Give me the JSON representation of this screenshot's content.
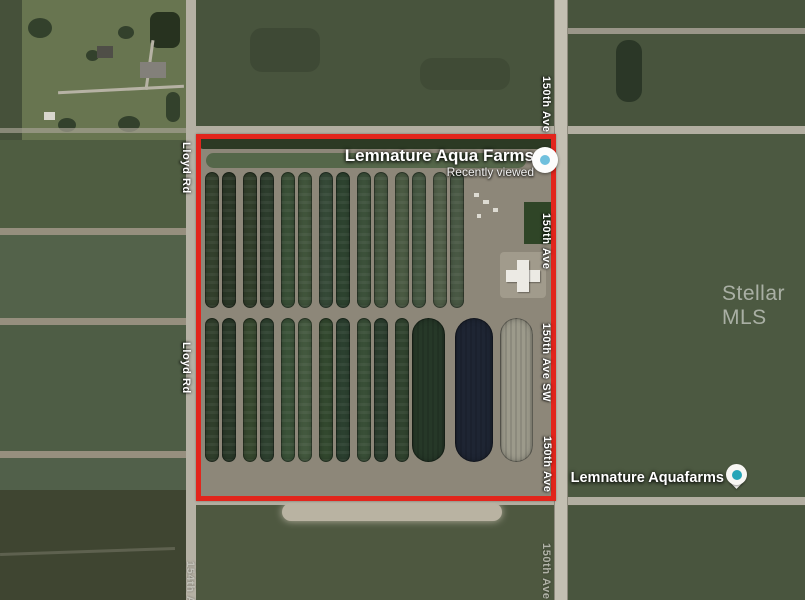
{
  "map": {
    "watermark": "Stellar MLS",
    "primary_place": {
      "name": "Lemnature Aqua Farms",
      "status": "Recently viewed"
    },
    "secondary_place": {
      "name": "Lemnature Aquafarms"
    },
    "road_labels": {
      "lloyd_upper": "Lloyd Rd",
      "lloyd_lower": "Lloyd Rd",
      "ave150_top": "150th Ave",
      "ave150_mid": "150th Ave",
      "ave150_sw": "150th Ave SW",
      "ave150_lower": "150th Ave",
      "ave150_bottom": "150th Ave",
      "ave154_bottom": "154th Ave"
    },
    "colors": {
      "boundary_red": "#e2251c",
      "pin_teal": "#26a5b8",
      "pin_dot_blue": "#6fc0dd"
    },
    "ponds": {
      "top_row": {
        "y": 172,
        "height": 136,
        "items": [
          {
            "x": 205,
            "w": 14,
            "c": "#34412d"
          },
          {
            "x": 222,
            "w": 14,
            "c": "#2b3827"
          },
          {
            "x": 243,
            "w": 14,
            "c": "#323f2b"
          },
          {
            "x": 260,
            "w": 14,
            "c": "#2d3d2d"
          },
          {
            "x": 281,
            "w": 14,
            "c": "#3a5037"
          },
          {
            "x": 298,
            "w": 14,
            "c": "#41553c"
          },
          {
            "x": 319,
            "w": 14,
            "c": "#364a38"
          },
          {
            "x": 336,
            "w": 14,
            "c": "#2e4430"
          },
          {
            "x": 357,
            "w": 14,
            "c": "#3d523b"
          },
          {
            "x": 374,
            "w": 14,
            "c": "#465740"
          },
          {
            "x": 395,
            "w": 14,
            "c": "#4b5b43"
          },
          {
            "x": 412,
            "w": 14,
            "c": "#465842"
          },
          {
            "x": 433,
            "w": 14,
            "c": "#516049"
          },
          {
            "x": 450,
            "w": 14,
            "c": "#4a5a45"
          }
        ]
      },
      "bottom_row": {
        "y": 318,
        "height": 144,
        "items": [
          {
            "x": 205,
            "w": 14,
            "c": "#31402c"
          },
          {
            "x": 222,
            "w": 14,
            "c": "#2a3a29"
          },
          {
            "x": 243,
            "w": 14,
            "c": "#37492f"
          },
          {
            "x": 260,
            "w": 14,
            "c": "#2f4230"
          },
          {
            "x": 281,
            "w": 14,
            "c": "#3b5339"
          },
          {
            "x": 298,
            "w": 14,
            "c": "#445a3f"
          },
          {
            "x": 319,
            "w": 14,
            "c": "#33492f"
          },
          {
            "x": 336,
            "w": 14,
            "c": "#2c4130"
          },
          {
            "x": 357,
            "w": 14,
            "c": "#3a5038"
          },
          {
            "x": 374,
            "w": 14,
            "c": "#2d3f2f"
          },
          {
            "x": 395,
            "w": 14,
            "c": "#31442f"
          },
          {
            "x": 412,
            "w": 33,
            "c": "#263828",
            "s": 1
          },
          {
            "x": 455,
            "w": 38,
            "c": "#1e2533",
            "s": 1
          },
          {
            "x": 500,
            "w": 33,
            "c": "#9c9a8b",
            "s": 1
          }
        ]
      }
    }
  }
}
